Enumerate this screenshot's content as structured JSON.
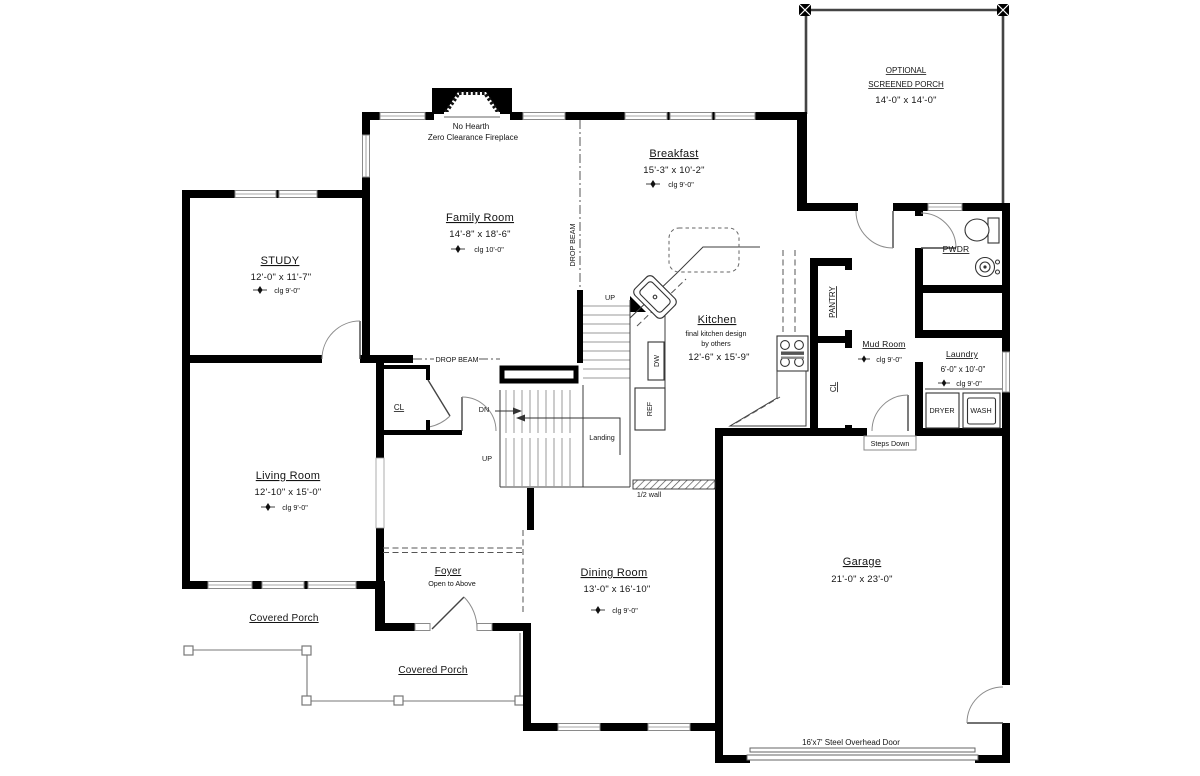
{
  "rooms": {
    "study": {
      "name": "STUDY",
      "dims": "12'-0\" x 11'-7\"",
      "clg": "clg 9'-0\""
    },
    "family_room": {
      "name": "Family Room",
      "dims": "14'-8\" x 18'-6\"",
      "clg": "clg 10'-0\""
    },
    "breakfast": {
      "name": "Breakfast",
      "dims": "15'-3\" x 10'-2\"",
      "clg": "clg 9'-0\""
    },
    "kitchen": {
      "name": "Kitchen",
      "note_line1": "final kitchen design",
      "note_line2": "by others",
      "dims": "12'-6\" x 15'-9\""
    },
    "living_room": {
      "name": "Living Room",
      "dims": "12'-10\" x 15'-0\"",
      "clg": "clg 9'-0\""
    },
    "dining_room": {
      "name": "Dining Room",
      "dims": "13'-0\" x 16'-10\"",
      "clg": "clg 9'-0\""
    },
    "foyer": {
      "name": "Foyer",
      "note": "Open to Above"
    },
    "garage": {
      "name": "Garage",
      "dims": "21'-0\" x 23'-0\""
    },
    "mud_room": {
      "name": "Mud Room",
      "clg": "clg 9'-0\""
    },
    "laundry": {
      "name": "Laundry",
      "dims": "6'-0\" x 10'-0\"",
      "clg": "clg 9'-0\""
    },
    "powder_room": {
      "name": "PWDR"
    },
    "screened_porch": {
      "name_line1": "OPTIONAL",
      "name_line2": "SCREENED PORCH",
      "dims": "14'-0\" x 14'-0\""
    },
    "covered_porch_left": {
      "name": "Covered Porch"
    },
    "covered_porch_right": {
      "name": "Covered Porch"
    }
  },
  "annotations": {
    "fireplace_line1": "No Hearth",
    "fireplace_line2": "Zero Clearance Fireplace",
    "drop_beam_vertical": "DROP BEAM",
    "drop_beam_horizontal": "DROP BEAM",
    "stair_up_top": "UP",
    "stair_dn": "DN",
    "stair_landing": "Landing",
    "stair_up_bottom": "UP",
    "half_wall": "1/2 wall",
    "steps_down": "Steps Down",
    "overhead_door": "16'x7' Steel Overhead Door",
    "pantry": "PANTRY",
    "closet_kitchen": "CL",
    "closet_hall": "CL",
    "dishwasher": "DW",
    "refrigerator": "REF",
    "dryer": "DRYER",
    "washer": "WASH"
  },
  "colors": {
    "walls": "#000000",
    "background": "#ffffff",
    "thin_lines": "#3c3c3c",
    "porch_lines": "#777777"
  }
}
